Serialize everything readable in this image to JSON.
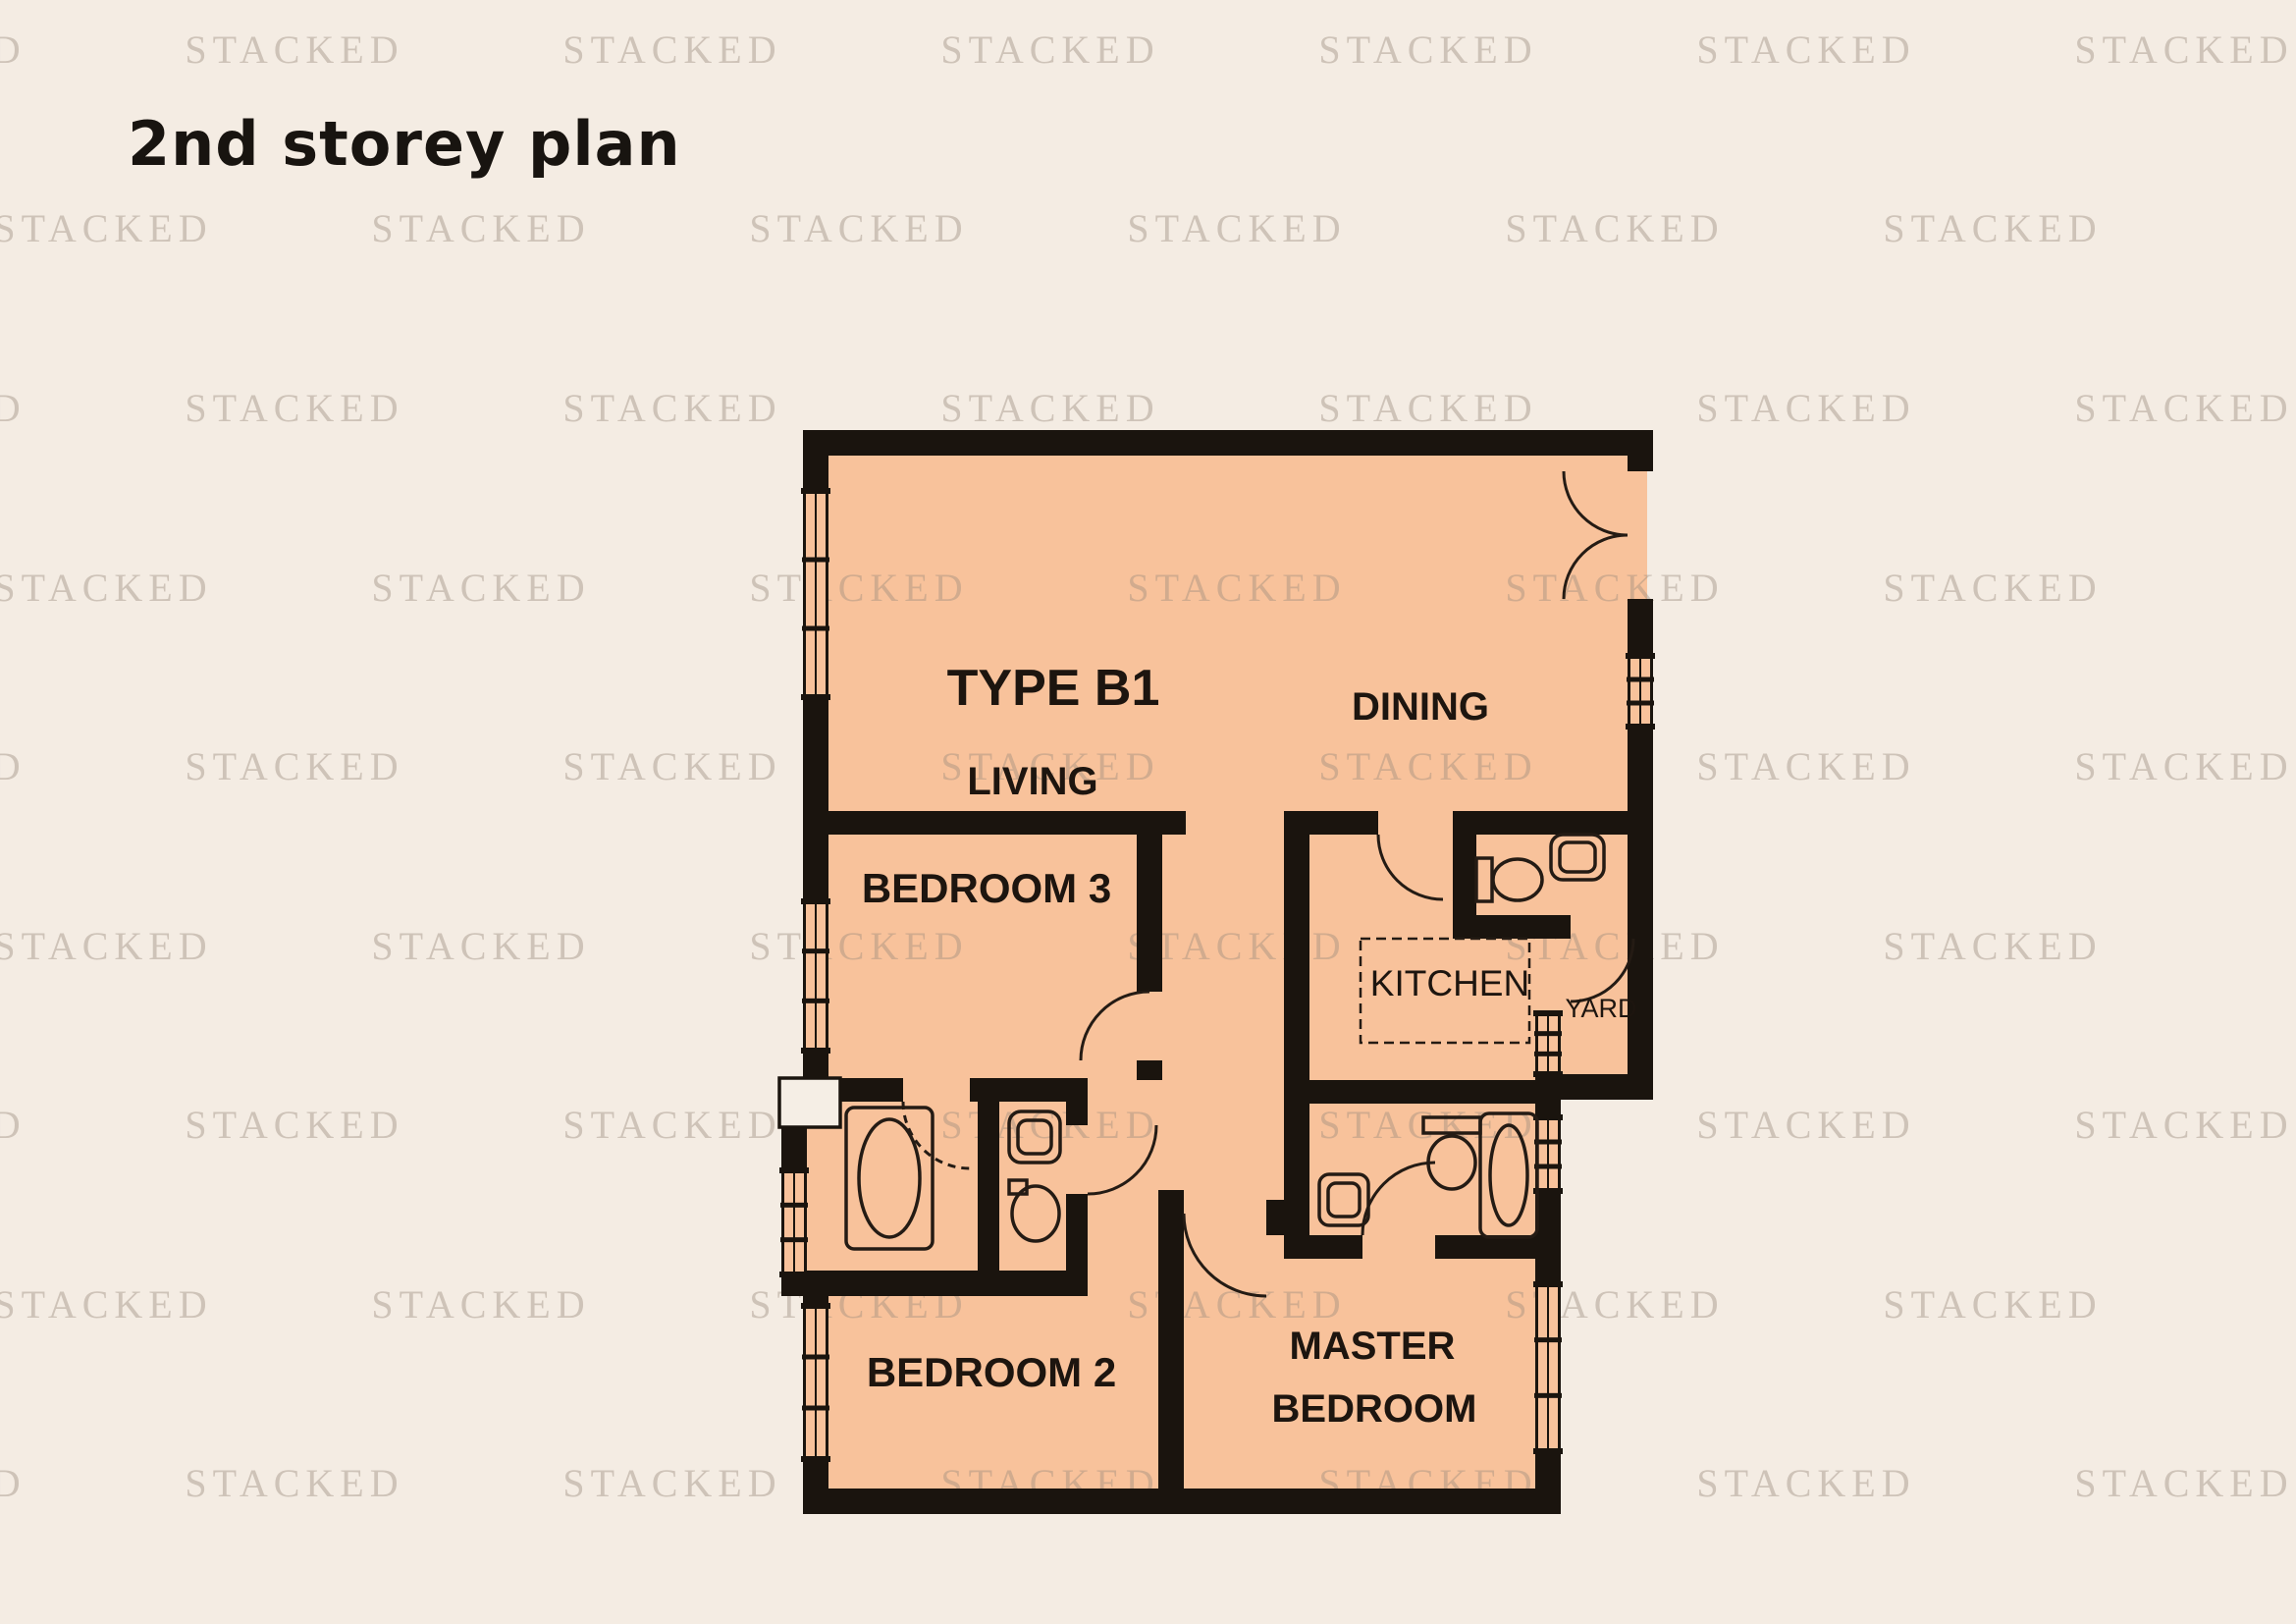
{
  "title": "2nd storey plan",
  "watermark": {
    "text": "STACKED"
  },
  "colors": {
    "background": "#f4ece3",
    "floor": "#f8c29b",
    "wall": "#1a140e",
    "label": "#1d150f",
    "watermark": "#9c8c7e"
  },
  "plan": {
    "unit_type": "TYPE B1",
    "labels": {
      "living": "LIVING",
      "dining": "DINING",
      "bedroom3": "BEDROOM 3",
      "kitchen": "KITCHEN",
      "yard": "YARD",
      "bedroom2": "BEDROOM 2",
      "master_line1": "MASTER",
      "master_line2": "BEDROOM"
    }
  }
}
